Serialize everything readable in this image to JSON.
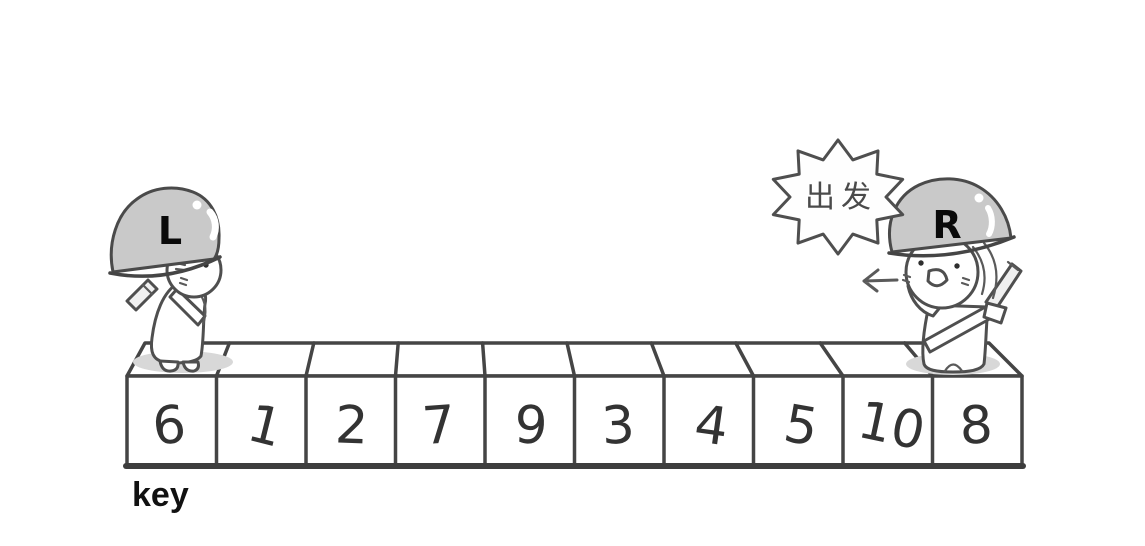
{
  "illustration": {
    "left_pointer": {
      "label": "L"
    },
    "right_pointer": {
      "label": "R"
    },
    "speech_bubble": {
      "text": "出发"
    },
    "arrow": {
      "glyph": "←",
      "direction": "left"
    },
    "array": {
      "values": [
        "6",
        "1",
        "2",
        "7",
        "9",
        "3",
        "4",
        "5",
        "10",
        "8"
      ],
      "key_label": "key"
    },
    "colors": {
      "background": "#ffffff",
      "line": "#454545",
      "helmet_gray": "#c9c9c9",
      "shadow_gray": "#d8d8d8",
      "number_text": "#333333",
      "label_text": "#0a0a0a"
    }
  }
}
